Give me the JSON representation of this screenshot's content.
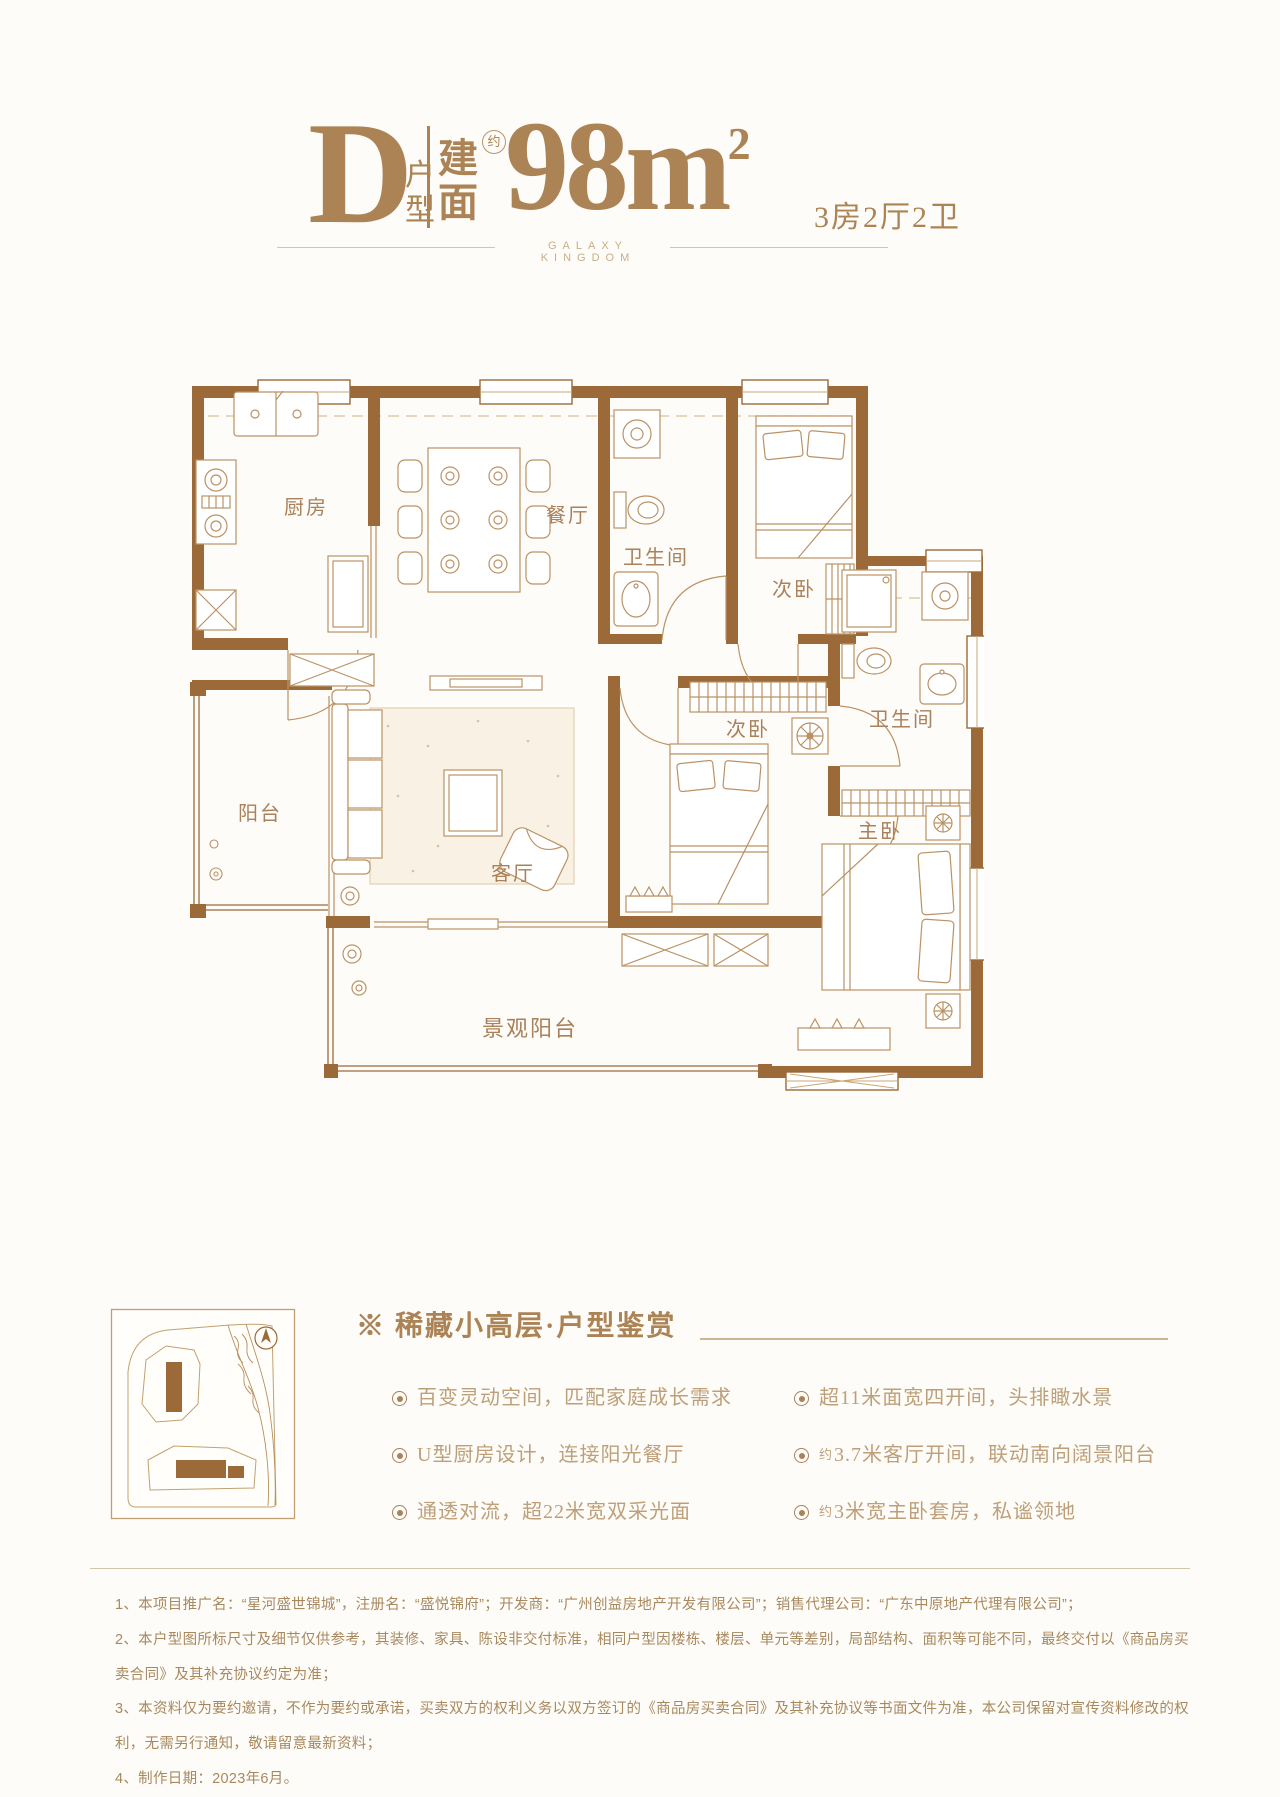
{
  "header": {
    "plan_letter": "D",
    "plan_type_char1": "户",
    "plan_type_char2": "型",
    "area_prefix_char1": "建",
    "area_prefix_char2": "面",
    "approx": "约",
    "area_value": "98m",
    "area_sup": "2",
    "layout_summary": "3房2厅2卫",
    "brand_line": "GALAXY KINGDOM"
  },
  "floor_plan": {
    "rooms": {
      "kitchen": "厨房",
      "dining": "餐厅",
      "bath_top": "卫生间",
      "bedroom_top": "次卧",
      "balcony": "阳台",
      "living": "客厅",
      "bedroom_mid": "次卧",
      "master": "主卧",
      "bath_right": "卫生间",
      "view_balcony": "景观阳台"
    },
    "colors": {
      "wall": "#9c6a39",
      "line": "#bb9264",
      "label": "#a9815a",
      "accent": "#ab8355"
    }
  },
  "features": {
    "title": "※ 稀藏小高层·户型鉴赏",
    "columns": [
      {
        "items": [
          {
            "text": "百变灵动空间，匹配家庭成长需求"
          },
          {
            "text": "U型厨房设计，连接阳光餐厅"
          },
          {
            "text": "通透对流，超22米宽双采光面"
          }
        ]
      },
      {
        "items": [
          {
            "text": "超11米面宽四开间，头排瞰水景"
          },
          {
            "prefix": "约",
            "text": "3.7米客厅开间，联动南向阔景阳台"
          },
          {
            "prefix": "约",
            "text": "3米宽主卧套房，私谧领地"
          }
        ]
      }
    ]
  },
  "footer": {
    "lines": [
      "1、本项目推广名：“星河盛世锦城”，注册名：“盛悦锦府”；开发商：“广州创益房地产开发有限公司”；销售代理公司：“广东中原地产代理有限公司”；",
      "2、本户型图所标尺寸及细节仅供参考，其装修、家具、陈设非交付标准，相同户型因楼栋、楼层、单元等差别，局部结构、面积等可能不同，最终交付以《商品房买卖合同》及其补充协议约定为准；",
      "3、本资料仅为要约邀请，不作为要约或承诺，买卖双方的权利义务以双方签订的《商品房买卖合同》及其补充协议等书面文件为准，本公司保留对宣传资料修改的权利，无需另行通知，敬请留意最新资料；",
      "4、制作日期：2023年6月。"
    ]
  }
}
